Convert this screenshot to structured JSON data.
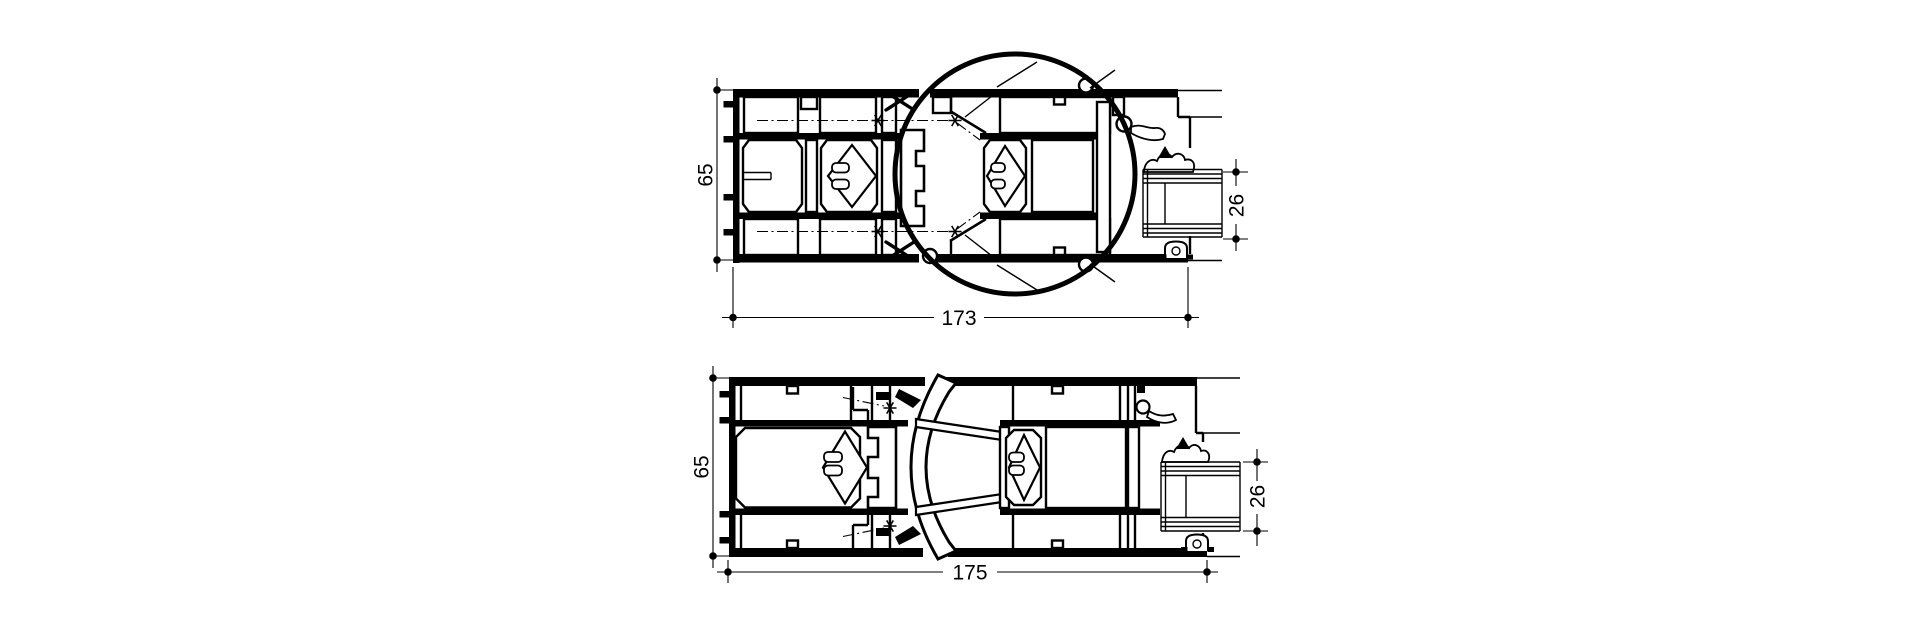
{
  "colors": {
    "line": "#000000",
    "background": "#ffffff"
  },
  "drawings": {
    "top_section": {
      "description": "profile cross-section with detail circle",
      "height_label": "65",
      "width_label": "173",
      "glazing_label": "26"
    },
    "bottom_section": {
      "description": "profile cross-section with curved astragal",
      "height_label": "65",
      "width_label": "175",
      "glazing_label": "26"
    }
  }
}
